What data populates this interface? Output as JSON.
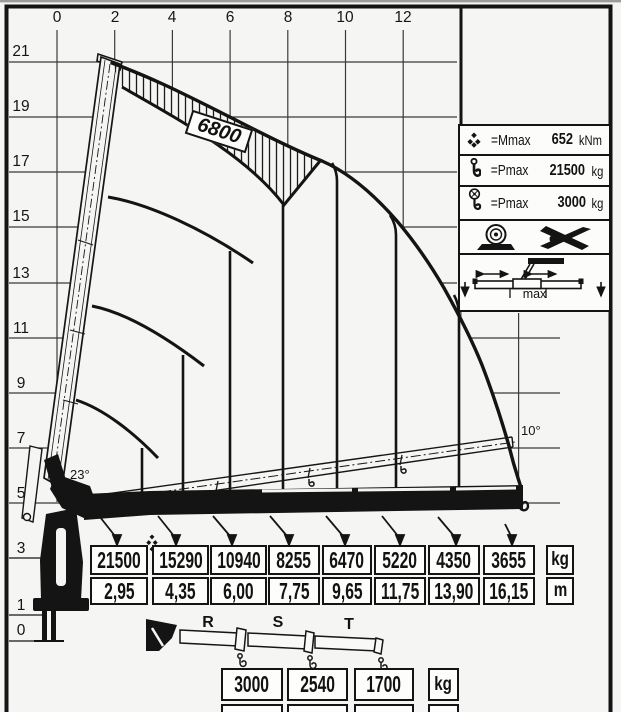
{
  "axes": {
    "x": [
      "0",
      "2",
      "4",
      "6",
      "8",
      "10",
      "12"
    ],
    "y": [
      "21",
      "19",
      "17",
      "15",
      "13",
      "11",
      "9",
      "7",
      "5",
      "3",
      "1",
      "0"
    ]
  },
  "badge": {
    "model": "6800"
  },
  "angles": {
    "main_boom_min": "23°",
    "fly_jib": "10°"
  },
  "info": {
    "rows": [
      {
        "label": "=Mmax",
        "value": "652",
        "unit": "kNm",
        "icon": "moment-diamonds-icon"
      },
      {
        "label": "=Pmax",
        "value": "21500",
        "unit": "kg",
        "icon": "hook-icon"
      },
      {
        "label": "=Pmax",
        "value": "3000",
        "unit": "kg",
        "icon": "winch-hook-icon"
      }
    ],
    "outrigger_label": "max"
  },
  "load_table": {
    "capacities": [
      "21500",
      "15290",
      "10940",
      "8255",
      "6470",
      "5220",
      "4350",
      "3655"
    ],
    "outreach": [
      "2,95",
      "4,35",
      "6,00",
      "7,75",
      "9,65",
      "11,75",
      "13,90",
      "16,15"
    ],
    "unit_top": "kg",
    "unit_bottom": "m"
  },
  "extensions": {
    "section_labels": [
      "R",
      "S",
      "T"
    ],
    "capacities": [
      "3000",
      "2540",
      "1700"
    ],
    "outreach": [
      "18,60",
      "21,10",
      "23,55"
    ],
    "unit_top": "kg",
    "unit_bottom": "m"
  },
  "chart_data": {
    "type": "table",
    "title": "Loader crane 6800 lifting capacity diagram",
    "x_axis": {
      "label": "outreach",
      "units": "m",
      "ticks": [
        0,
        2,
        4,
        6,
        8,
        10,
        12
      ],
      "range": [
        0,
        16.15
      ]
    },
    "y_axis": {
      "label": "height",
      "units": "m",
      "ticks": [
        21,
        19,
        17,
        15,
        13,
        11,
        9,
        7,
        5,
        3,
        1,
        0
      ]
    },
    "hydraulic_boom": {
      "outreach_m": [
        2.95,
        4.35,
        6.0,
        7.75,
        9.65,
        11.75,
        13.9,
        16.15
      ],
      "capacity_kg": [
        21500,
        15290,
        10940,
        8255,
        6470,
        5220,
        4350,
        3655
      ]
    },
    "manual_extensions": {
      "labels": [
        "R",
        "S",
        "T"
      ],
      "outreach_m": [
        18.6,
        21.1,
        23.55
      ],
      "capacity_kg": [
        3000,
        2540,
        1700
      ]
    },
    "ratings": {
      "Mmax_kNm": 652,
      "Pmax_kg": 21500,
      "Pmax_winch_kg": 3000
    },
    "boom_angles_deg": [
      23,
      10
    ],
    "grid": "on"
  }
}
